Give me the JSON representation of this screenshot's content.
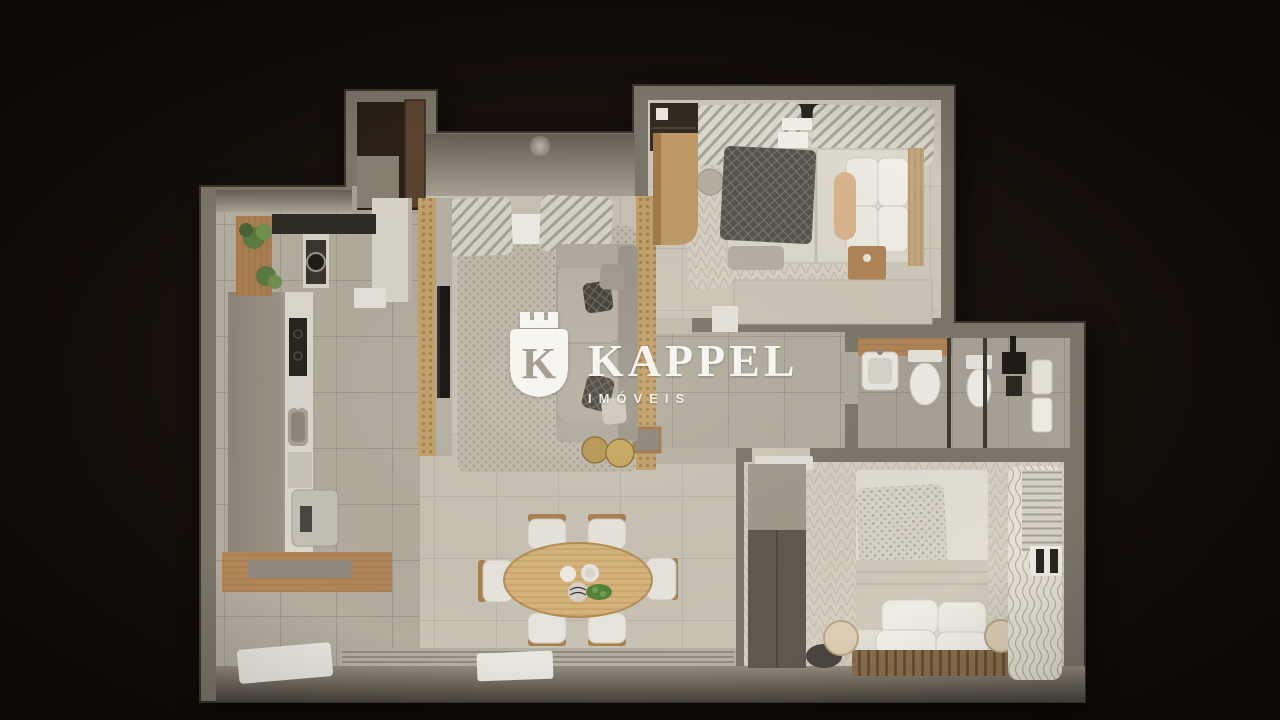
{
  "scene": {
    "type": "3d-floor-plan-render",
    "view": "top-down dollhouse render of an apartment, dark background",
    "background_color": "#140d08"
  },
  "watermark": {
    "logo_letter": "K",
    "brand": "KAPPEL",
    "tagline": "IMÓVEIS",
    "color": "#fdfcf8"
  },
  "palette": {
    "wall": "#7c756a",
    "tile_floor": "#b2ac9f",
    "living_floor": "#c9c3b6",
    "bedroom_floor": "#d4cdc0",
    "wood": "#b28657",
    "rattan_divider": "#c2a069",
    "table_wood": "#d8b57c",
    "upholstery": "#b3ada1",
    "linen": "#e9e6de",
    "plant_green": "#6f8f4e",
    "dark_fixture": "#26221d"
  },
  "rooms": [
    {
      "id": "entry-hall",
      "contents": [
        "entry-door",
        "dark-vestibule",
        "closet-cabinet"
      ]
    },
    {
      "id": "kitchen-laundry",
      "contents": [
        "plant-shelf",
        "dark-counter",
        "washer-stack",
        "tall-cabinets",
        "cooktop",
        "sink",
        "counter-appliance",
        "wood-bar-counter",
        "white-mat"
      ]
    },
    {
      "id": "living-room",
      "contents": [
        "rattan-tv-divider",
        "tv",
        "curtains",
        "area-rug",
        "sofa",
        "patterned-pillows",
        "round-side-tables",
        "ceiling-lamp"
      ]
    },
    {
      "id": "dining-area",
      "contents": [
        "oval-wood-table",
        "six-chairs",
        "plates",
        "green-centerpiece",
        "doormat",
        "sliding-door-track"
      ]
    },
    {
      "id": "bedroom-1",
      "contents": [
        "double-bed",
        "dark-knit-throw",
        "pillows",
        "wood-headboard",
        "desk",
        "desk-chair",
        "nightstand",
        "foot-bench",
        "low-cabinet",
        "window-curtains",
        "herringbone-rug",
        "closet-recess"
      ]
    },
    {
      "id": "bathroom",
      "contents": [
        "wood-vanity",
        "sink",
        "toilet",
        "glass-shower-partition",
        "second-basin",
        "black-shower-column",
        "towels"
      ]
    },
    {
      "id": "bedroom-2",
      "contents": [
        "double-bed",
        "knit-throw",
        "four-pillows",
        "slatted-headboard",
        "round-nightstands",
        "wardrobe",
        "wavy-curtains",
        "window-blinds",
        "dark-floor-cushion",
        "open-door"
      ]
    }
  ]
}
